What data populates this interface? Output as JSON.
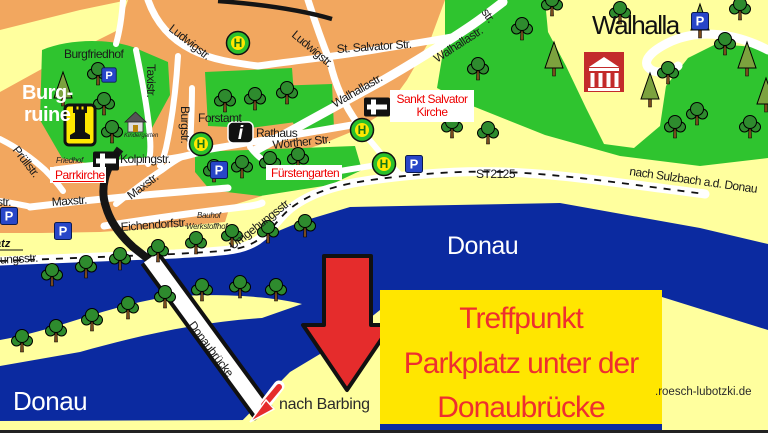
{
  "map": {
    "region_labels": {
      "walhalla": "Walhalla",
      "burgruine_line1": "Burg-",
      "burgruine_line2": "ruine",
      "burgfriedhof": "Burgfriedhof",
      "friedhof": "Friedhof",
      "forstamt": "Forstamt",
      "rathaus": "Rathaus",
      "kindergarten": "Kindergarten",
      "parrkirche": "Parrkirche",
      "fuerstengarten": "Fürstengarten",
      "sankt_salvator_line1": "Sankt Salvator",
      "sankt_salvator_line2": "Kirche",
      "bauhof": "Bauhof",
      "werkstoffhof": "Werkstoffhof",
      "donau_upper": "Donau",
      "donau_lower": "Donau",
      "platz_fragment": "latz"
    },
    "streets": {
      "ludwigstr": "Ludwigstr.",
      "st_salvator_str": "St. Salvator Str.",
      "walhallastr": "Walhallastr.",
      "taxistr": "Taxistr.",
      "burgstr": "Burgstr.",
      "woerther_str": "Wörther Str.",
      "kolpingstr": "Kolpingstr.",
      "pruellstr": "Prüllstr.",
      "maxstr": "Maxstr.",
      "eichendorfstr": "Eichendorfstr.",
      "umgehungsstr": "Umgehungsstr.",
      "umgehungsstr_fragment": "hungsstr.",
      "str_fragment": "str.",
      "st2125": "ST2125",
      "donaubruecke": "Donaubrücke"
    },
    "directions": {
      "nach_sulzbach": "nach Sulzbach a.d. Donau",
      "nach_barbing": "nach Barbing"
    },
    "icons": {
      "parking_glyph": "P",
      "bus_stop_glyph": "H",
      "info_glyph": "i"
    },
    "annotation_box": {
      "line1": "Treffpunkt",
      "line2": "Parkplatz unter der",
      "line3": "Donaubrücke"
    },
    "watermark": ".roesch-lubotzki.de",
    "colors": {
      "town_orange": "#f2a75f",
      "field_yellow": "#ffff9e",
      "park_green": "#2fc42f",
      "river_blue": "#0b2aa0",
      "road_white": "#ffffff",
      "annotation_yellow": "#ffe600",
      "annotation_text_red": "#ee2f2f",
      "arrow_red": "#e52c2c",
      "landmark_red": "#c32b2b",
      "parking_blue": "#2846c8",
      "bus_stop_green": "#2bc02b"
    }
  }
}
